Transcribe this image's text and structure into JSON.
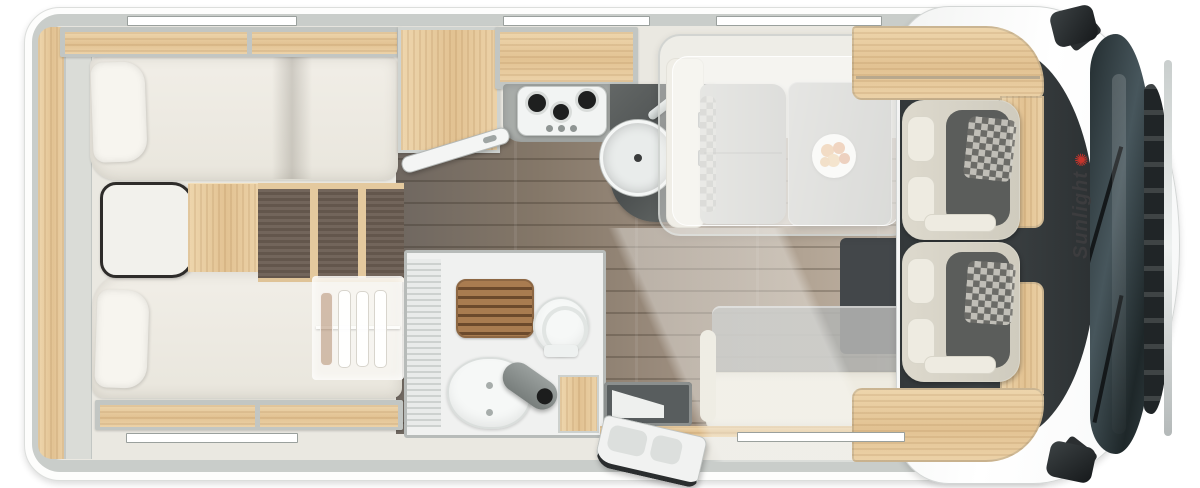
{
  "brand": {
    "name": "Sunlight",
    "logo_icon": "✺"
  },
  "colors": {
    "wall_gray": "#c9cdca",
    "interior_cream": "#eae8e1",
    "oak": "#e6c89c",
    "dark_wood": "#6b5d52",
    "teak": "#a97c50",
    "floor_dark": "#6f6760",
    "floor_light": "#c3b7a9",
    "cab_dark": "#3e4345",
    "glass_dark": "#2c3537",
    "brand_red": "#c8352c",
    "brand_text": "#3c3c3e"
  }
}
